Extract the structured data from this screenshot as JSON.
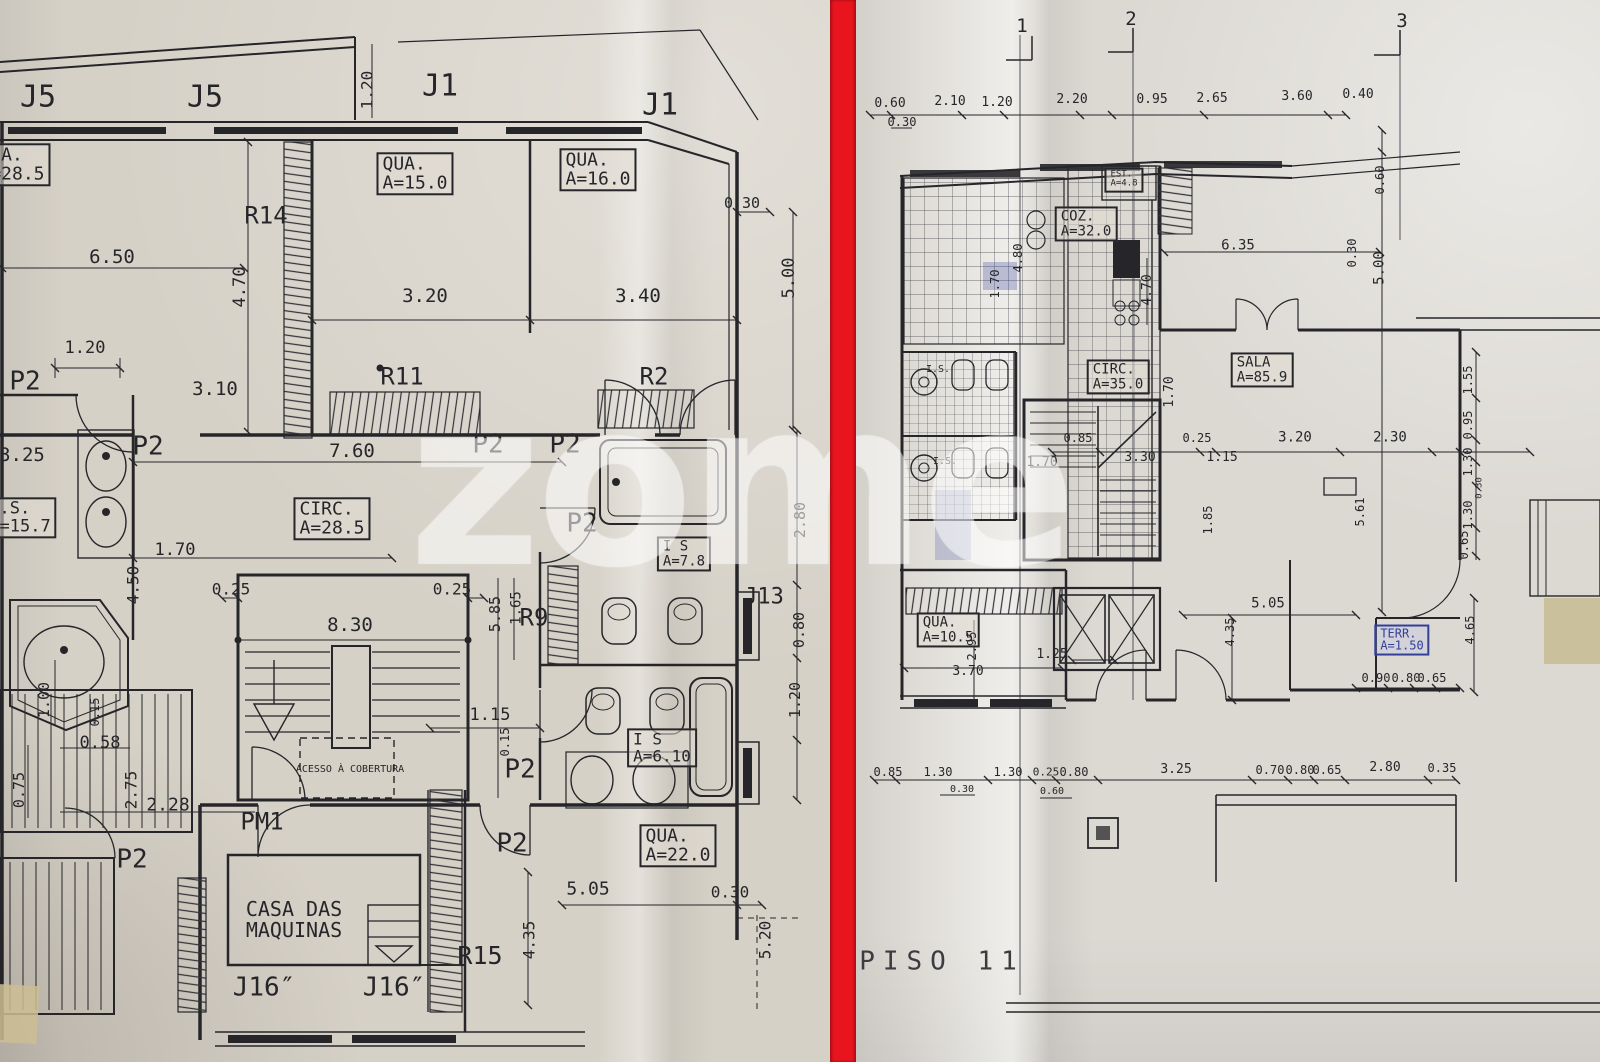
{
  "colors": {
    "divider": "#e8141e",
    "ink": "#26262a",
    "stamp_blue": "#32409c"
  },
  "watermark": "zome",
  "left_plan": {
    "name": "floor-plan-sheet-left",
    "labels": [
      {
        "n": "window-tag",
        "t": "J5",
        "x": 38,
        "y": 97,
        "s": 30
      },
      {
        "n": "window-tag",
        "t": "J5",
        "x": 205,
        "y": 97,
        "s": 30
      },
      {
        "n": "window-tag",
        "t": "J1",
        "x": 440,
        "y": 86,
        "s": 30
      },
      {
        "n": "window-tag",
        "t": "J1",
        "x": 660,
        "y": 105,
        "s": 30
      },
      {
        "n": "dim",
        "t": "1.20",
        "x": 368,
        "y": 90,
        "s": 16,
        "r": 1
      },
      {
        "n": "room-label",
        "t": "QUA.\nA=28.5",
        "x": 12,
        "y": 165,
        "s": 18,
        "b": 1
      },
      {
        "n": "room-label",
        "t": "QUA.\nA=15.0",
        "x": 415,
        "y": 174,
        "s": 18,
        "b": 1
      },
      {
        "n": "room-label",
        "t": "QUA.\nA=16.0",
        "x": 598,
        "y": 170,
        "s": 18,
        "b": 1
      },
      {
        "n": "radiator-tag",
        "t": "R14",
        "x": 266,
        "y": 216,
        "s": 24
      },
      {
        "n": "dim",
        "t": "0.30",
        "x": 742,
        "y": 204,
        "s": 15
      },
      {
        "n": "dim",
        "t": "6.50",
        "x": 112,
        "y": 258,
        "s": 19
      },
      {
        "n": "dim",
        "t": "4.70",
        "x": 241,
        "y": 287,
        "s": 17,
        "r": 1
      },
      {
        "n": "dim",
        "t": "5.00",
        "x": 790,
        "y": 278,
        "s": 17,
        "r": 1
      },
      {
        "n": "dim",
        "t": "3.20",
        "x": 425,
        "y": 297,
        "s": 19
      },
      {
        "n": "dim",
        "t": "3.40",
        "x": 638,
        "y": 297,
        "s": 19
      },
      {
        "n": "dim",
        "t": "1.20",
        "x": 85,
        "y": 349,
        "s": 17
      },
      {
        "n": "door-tag",
        "t": "P2",
        "x": 25,
        "y": 382,
        "s": 26
      },
      {
        "n": "dim",
        "t": "3.10",
        "x": 215,
        "y": 390,
        "s": 19
      },
      {
        "n": "radiator-tag",
        "t": "R11",
        "x": 402,
        "y": 377,
        "s": 24
      },
      {
        "n": "radiator-tag",
        "t": "R2",
        "x": 654,
        "y": 377,
        "s": 24
      },
      {
        "n": "door-tag",
        "t": "P2",
        "x": 148,
        "y": 447,
        "s": 26
      },
      {
        "n": "door-tag",
        "t": "P2",
        "x": 488,
        "y": 445,
        "s": 26
      },
      {
        "n": "door-tag",
        "t": "P2",
        "x": 565,
        "y": 445,
        "s": 26
      },
      {
        "n": "dim",
        "t": "3.25",
        "x": 22,
        "y": 456,
        "s": 19
      },
      {
        "n": "dim",
        "t": "7.60",
        "x": 352,
        "y": 452,
        "s": 19
      },
      {
        "n": "room-label",
        "t": "I.S.\nA=15.7",
        "x": 20,
        "y": 518,
        "s": 17,
        "b": 1
      },
      {
        "n": "room-label",
        "t": "CIRC.\nA=28.5",
        "x": 332,
        "y": 519,
        "s": 18,
        "b": 1
      },
      {
        "n": "door-tag",
        "t": "P2",
        "x": 582,
        "y": 524,
        "s": 26
      },
      {
        "n": "room-label",
        "t": "I S\nA=7.8",
        "x": 684,
        "y": 554,
        "s": 14,
        "b": 1
      },
      {
        "n": "dim",
        "t": "2.80",
        "x": 801,
        "y": 520,
        "s": 15,
        "r": 1
      },
      {
        "n": "dim",
        "t": "1.70",
        "x": 175,
        "y": 551,
        "s": 17
      },
      {
        "n": "dim",
        "t": "4.50",
        "x": 134,
        "y": 585,
        "s": 16,
        "r": 1
      },
      {
        "n": "dim",
        "t": "0.25",
        "x": 231,
        "y": 590,
        "s": 16
      },
      {
        "n": "dim",
        "t": "0.25",
        "x": 452,
        "y": 590,
        "s": 16
      },
      {
        "n": "dim",
        "t": "5.85",
        "x": 496,
        "y": 614,
        "s": 15,
        "r": 1
      },
      {
        "n": "dim",
        "t": "1.65",
        "x": 517,
        "y": 608,
        "s": 14,
        "r": 1
      },
      {
        "n": "radiator-tag",
        "t": "R9",
        "x": 534,
        "y": 618,
        "s": 24
      },
      {
        "n": "dim",
        "t": "8.30",
        "x": 350,
        "y": 626,
        "s": 19
      },
      {
        "n": "window-tag",
        "t": "J13",
        "x": 764,
        "y": 598,
        "s": 22
      },
      {
        "n": "dim",
        "t": "0.80",
        "x": 800,
        "y": 630,
        "s": 15,
        "r": 1
      },
      {
        "n": "dim",
        "t": "1.00",
        "x": 45,
        "y": 700,
        "s": 15,
        "r": 1
      },
      {
        "n": "dim",
        "t": "0.15",
        "x": 95,
        "y": 712,
        "s": 12,
        "r": 1
      },
      {
        "n": "dim",
        "t": "0.58",
        "x": 100,
        "y": 744,
        "s": 17
      },
      {
        "n": "dim",
        "t": "1.15",
        "x": 490,
        "y": 716,
        "s": 17
      },
      {
        "n": "room-label",
        "t": "I S\nA=6.10",
        "x": 662,
        "y": 748,
        "s": 16,
        "b": 1
      },
      {
        "n": "dim",
        "t": "1.20",
        "x": 796,
        "y": 700,
        "s": 15,
        "r": 1
      },
      {
        "n": "dim",
        "t": "0.75",
        "x": 20,
        "y": 790,
        "s": 15,
        "r": 1
      },
      {
        "n": "dim",
        "t": "2.75",
        "x": 132,
        "y": 790,
        "s": 16,
        "r": 1
      },
      {
        "n": "dim",
        "t": "2.28",
        "x": 168,
        "y": 806,
        "s": 18
      },
      {
        "n": "note",
        "t": "ACESSO À COBERTURA",
        "x": 350,
        "y": 770,
        "s": 10
      },
      {
        "n": "dim",
        "t": "0.15",
        "x": 505,
        "y": 742,
        "s": 12,
        "r": 1
      },
      {
        "n": "door-tag",
        "t": "P2",
        "x": 520,
        "y": 770,
        "s": 26
      },
      {
        "n": "door-tag",
        "t": "PM1",
        "x": 262,
        "y": 822,
        "s": 24
      },
      {
        "n": "door-tag",
        "t": "P2",
        "x": 512,
        "y": 844,
        "s": 26
      },
      {
        "n": "door-tag",
        "t": "P2",
        "x": 132,
        "y": 860,
        "s": 26
      },
      {
        "n": "room-label",
        "t": "QUA.\nA=22.0",
        "x": 678,
        "y": 846,
        "s": 18,
        "b": 1
      },
      {
        "n": "dim",
        "t": "5.05",
        "x": 588,
        "y": 890,
        "s": 18
      },
      {
        "n": "dim",
        "t": "0.30",
        "x": 730,
        "y": 893,
        "s": 16
      },
      {
        "n": "room-label",
        "t": "CASA DAS\nMAQUINAS",
        "x": 294,
        "y": 920,
        "s": 20
      },
      {
        "n": "dim",
        "t": "5.20",
        "x": 766,
        "y": 940,
        "s": 16,
        "r": 1
      },
      {
        "n": "radiator-tag",
        "t": "R15",
        "x": 480,
        "y": 956,
        "s": 25
      },
      {
        "n": "dim",
        "t": "4.35",
        "x": 530,
        "y": 940,
        "s": 16,
        "r": 1
      },
      {
        "n": "window-tag",
        "t": "J16″",
        "x": 264,
        "y": 988,
        "s": 26
      },
      {
        "n": "window-tag",
        "t": "J16″",
        "x": 394,
        "y": 988,
        "s": 26
      }
    ]
  },
  "right_plan": {
    "name": "floor-plan-sheet-right",
    "title": "PISO 11",
    "labels": [
      {
        "n": "grid-number",
        "t": "1",
        "x": 1022,
        "y": 27,
        "s": 19
      },
      {
        "n": "grid-number",
        "t": "2",
        "x": 1131,
        "y": 20,
        "s": 19
      },
      {
        "n": "grid-number",
        "t": "3",
        "x": 1402,
        "y": 22,
        "s": 19
      },
      {
        "n": "dim",
        "t": "0.60",
        "x": 890,
        "y": 104,
        "s": 13
      },
      {
        "n": "dim",
        "t": "2.10",
        "x": 950,
        "y": 102,
        "s": 13
      },
      {
        "n": "dim",
        "t": "1.20",
        "x": 997,
        "y": 103,
        "s": 13
      },
      {
        "n": "dim",
        "t": "2.20",
        "x": 1072,
        "y": 100,
        "s": 13
      },
      {
        "n": "dim",
        "t": "0.95",
        "x": 1152,
        "y": 100,
        "s": 13
      },
      {
        "n": "dim",
        "t": "2.65",
        "x": 1212,
        "y": 99,
        "s": 13
      },
      {
        "n": "dim",
        "t": "3.60",
        "x": 1297,
        "y": 97,
        "s": 13
      },
      {
        "n": "dim",
        "t": "0.40",
        "x": 1358,
        "y": 95,
        "s": 13
      },
      {
        "n": "dim",
        "t": "0.30",
        "x": 902,
        "y": 122,
        "s": 12
      },
      {
        "n": "room-label",
        "t": "EST.\nA=4.8",
        "x": 1124,
        "y": 180,
        "s": 9,
        "b": 1
      },
      {
        "n": "room-label",
        "t": "COZ.\nA=32.0",
        "x": 1086,
        "y": 224,
        "s": 14,
        "b": 1
      },
      {
        "n": "dim",
        "t": "4.80",
        "x": 1018,
        "y": 258,
        "s": 12,
        "r": 1
      },
      {
        "n": "dim",
        "t": "1.70",
        "x": 995,
        "y": 284,
        "s": 12,
        "r": 1
      },
      {
        "n": "dim",
        "t": "6.35",
        "x": 1238,
        "y": 246,
        "s": 14
      },
      {
        "n": "dim",
        "t": "4.70",
        "x": 1148,
        "y": 290,
        "s": 13,
        "r": 1
      },
      {
        "n": "dim",
        "t": "0.30",
        "x": 1352,
        "y": 253,
        "s": 12,
        "r": 1
      },
      {
        "n": "dim",
        "t": "0.60",
        "x": 1380,
        "y": 180,
        "s": 12,
        "r": 1
      },
      {
        "n": "dim",
        "t": "5.00",
        "x": 1380,
        "y": 268,
        "s": 14,
        "r": 1
      },
      {
        "n": "room-label",
        "t": "SALA\nA=85.9",
        "x": 1262,
        "y": 370,
        "s": 14,
        "b": 1
      },
      {
        "n": "room-label",
        "t": "CIRC.\nA=35.0",
        "x": 1118,
        "y": 377,
        "s": 14,
        "b": 1
      },
      {
        "n": "dim",
        "t": "1.70",
        "x": 1170,
        "y": 392,
        "s": 13,
        "r": 1
      },
      {
        "n": "room-label",
        "t": "I.S.",
        "x": 938,
        "y": 370,
        "s": 10
      },
      {
        "n": "room-label",
        "t": "I.S.",
        "x": 945,
        "y": 462,
        "s": 10
      },
      {
        "n": "dim",
        "t": "0.85",
        "x": 1078,
        "y": 438,
        "s": 12
      },
      {
        "n": "dim",
        "t": "0.25",
        "x": 1197,
        "y": 438,
        "s": 12
      },
      {
        "n": "dim",
        "t": "3.30",
        "x": 1140,
        "y": 458,
        "s": 13
      },
      {
        "n": "dim",
        "t": "1.15",
        "x": 1222,
        "y": 458,
        "s": 13
      },
      {
        "n": "dim",
        "t": "3.20",
        "x": 1295,
        "y": 438,
        "s": 14
      },
      {
        "n": "dim",
        "t": "2.30",
        "x": 1390,
        "y": 438,
        "s": 14
      },
      {
        "n": "dim",
        "t": "1.70",
        "x": 1042,
        "y": 463,
        "s": 13
      },
      {
        "n": "dim",
        "t": "1.55",
        "x": 1468,
        "y": 380,
        "s": 12,
        "r": 1
      },
      {
        "n": "dim",
        "t": "0.95",
        "x": 1468,
        "y": 425,
        "s": 12,
        "r": 1
      },
      {
        "n": "dim",
        "t": "1.30",
        "x": 1468,
        "y": 462,
        "s": 12,
        "r": 1
      },
      {
        "n": "dim",
        "t": "0.30",
        "x": 1480,
        "y": 488,
        "s": 9,
        "r": 1
      },
      {
        "n": "dim",
        "t": "1.30",
        "x": 1468,
        "y": 515,
        "s": 12,
        "r": 1
      },
      {
        "n": "dim",
        "t": "0.65",
        "x": 1464,
        "y": 545,
        "s": 12,
        "r": 1
      },
      {
        "n": "dim",
        "t": "5.61",
        "x": 1360,
        "y": 512,
        "s": 12,
        "r": 1
      },
      {
        "n": "dim",
        "t": "1.85",
        "x": 1208,
        "y": 520,
        "s": 12,
        "r": 1
      },
      {
        "n": "room-label",
        "t": "QUA.\nA=10.5",
        "x": 948,
        "y": 630,
        "s": 14,
        "b": 1
      },
      {
        "n": "dim",
        "t": "2.95",
        "x": 972,
        "y": 646,
        "s": 12,
        "r": 1
      },
      {
        "n": "dim",
        "t": "3.70",
        "x": 968,
        "y": 672,
        "s": 13
      },
      {
        "n": "dim",
        "t": "1.25",
        "x": 1052,
        "y": 655,
        "s": 13
      },
      {
        "n": "dim",
        "t": "5.05",
        "x": 1268,
        "y": 604,
        "s": 14
      },
      {
        "n": "dim",
        "t": "4.35",
        "x": 1230,
        "y": 632,
        "s": 12,
        "r": 1
      },
      {
        "n": "room-label-stamp",
        "t": "TERR.\nA=1.50",
        "x": 1402,
        "y": 640,
        "s": 12,
        "b": 1,
        "c": 1
      },
      {
        "n": "dim",
        "t": "0.90",
        "x": 1376,
        "y": 678,
        "s": 12
      },
      {
        "n": "dim",
        "t": "0.80",
        "x": 1406,
        "y": 678,
        "s": 12
      },
      {
        "n": "dim",
        "t": "0.65",
        "x": 1432,
        "y": 678,
        "s": 12
      },
      {
        "n": "dim",
        "t": "4.65",
        "x": 1470,
        "y": 630,
        "s": 12,
        "r": 1
      },
      {
        "n": "dim",
        "t": "0.85",
        "x": 888,
        "y": 772,
        "s": 12
      },
      {
        "n": "dim",
        "t": "1.30",
        "x": 938,
        "y": 772,
        "s": 12
      },
      {
        "n": "dim",
        "t": "1.30",
        "x": 1008,
        "y": 772,
        "s": 12
      },
      {
        "n": "dim",
        "t": "0.25",
        "x": 1046,
        "y": 772,
        "s": 11
      },
      {
        "n": "dim",
        "t": "0.80",
        "x": 1074,
        "y": 772,
        "s": 12
      },
      {
        "n": "dim",
        "t": "3.25",
        "x": 1176,
        "y": 770,
        "s": 13
      },
      {
        "n": "dim",
        "t": "0.70",
        "x": 1270,
        "y": 770,
        "s": 12
      },
      {
        "n": "dim",
        "t": "0.80",
        "x": 1300,
        "y": 770,
        "s": 12
      },
      {
        "n": "dim",
        "t": "0.65",
        "x": 1327,
        "y": 770,
        "s": 12
      },
      {
        "n": "dim",
        "t": "2.80",
        "x": 1385,
        "y": 768,
        "s": 13
      },
      {
        "n": "dim",
        "t": "0.35",
        "x": 1442,
        "y": 768,
        "s": 12
      },
      {
        "n": "dim",
        "t": "0.30",
        "x": 962,
        "y": 790,
        "s": 10
      },
      {
        "n": "dim",
        "t": "0.60",
        "x": 1052,
        "y": 792,
        "s": 10
      },
      {
        "n": "floor-title",
        "t": "PISO 11",
        "x": 942,
        "y": 962,
        "s": 26,
        "st": 1
      }
    ]
  }
}
